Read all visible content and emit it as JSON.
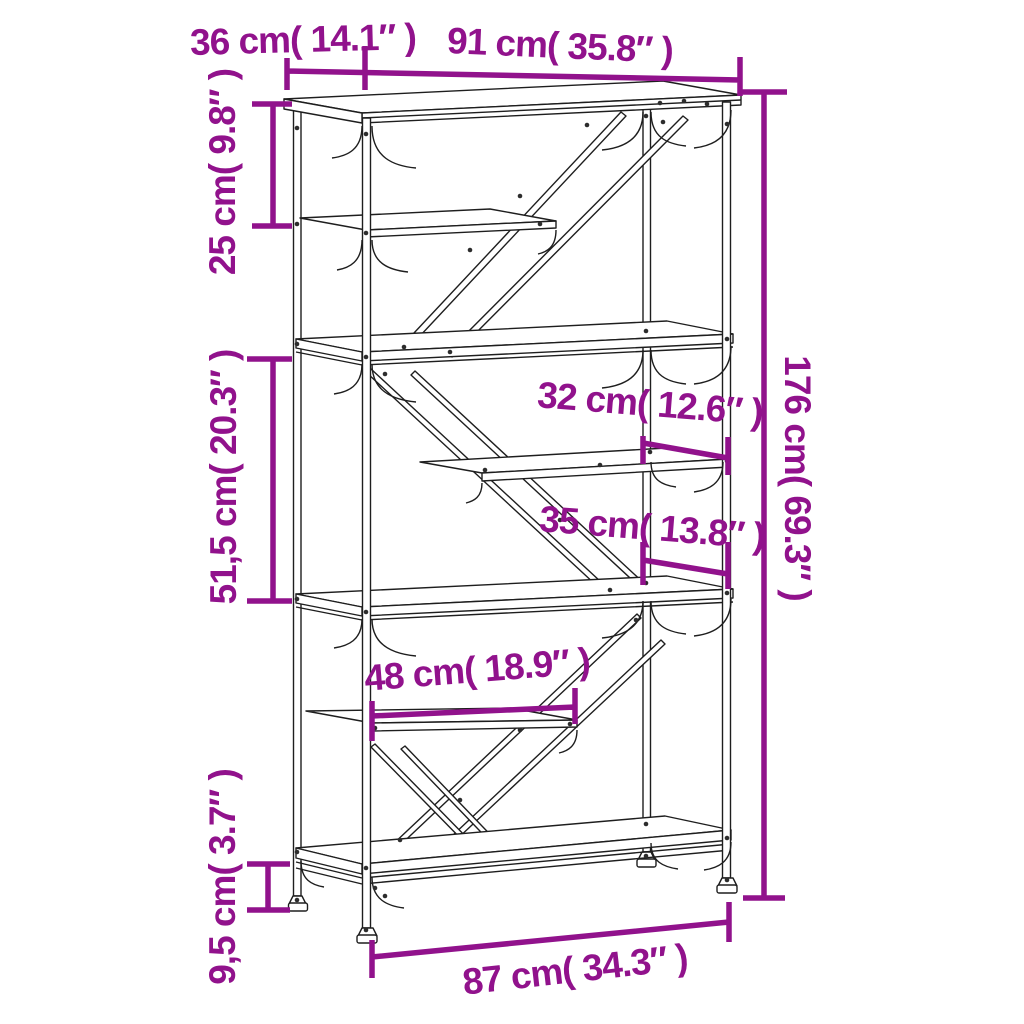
{
  "page": {
    "background_color": "#ffffff"
  },
  "diagram": {
    "kind": "furniture-dimension-diagram",
    "subject": "industrial 5-tier bookshelf line drawing with measurements",
    "accent_color": "#91128C",
    "line_color": "#1e1e1e",
    "labels": {
      "top_depth": "36 cm( 14.1″ )",
      "top_width": "91 cm( 35.8″ )",
      "upper_shelf_gap": "25 cm( 9.8″ )",
      "middle_shelf_gap": "51,5 cm( 20.3″ )",
      "total_height": "176 cm( 69.3″ )",
      "upper_inner_shelf_depth": "32 cm( 12.6″ )",
      "lower_inner_shelf_depth": "35 cm( 13.8″ )",
      "inner_shelf_width": "48 cm( 18.9″ )",
      "bottom_clearance": "9,5 cm( 3.7″ )",
      "bottom_width": "87 cm( 34.3″ )"
    }
  }
}
